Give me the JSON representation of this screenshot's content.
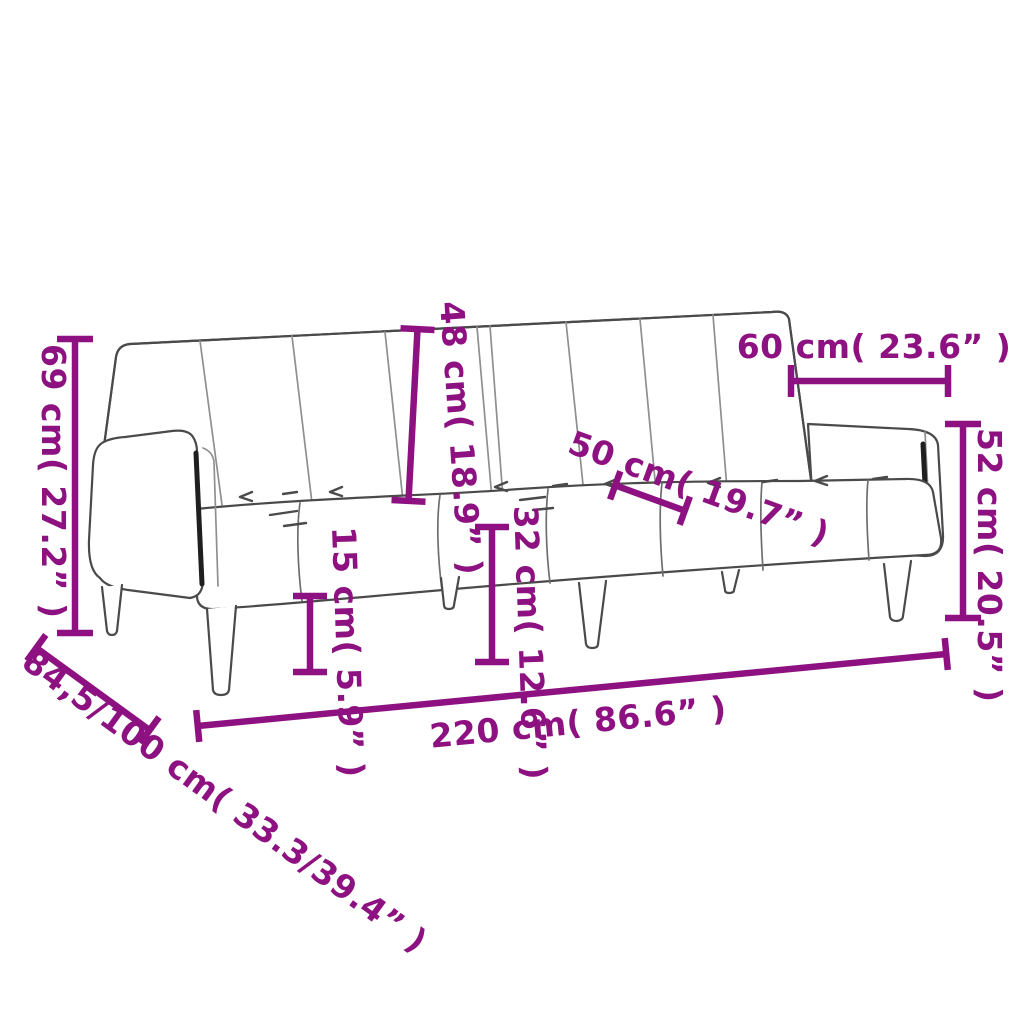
{
  "drawing": {
    "subject": "two-seater sofa bed line drawing with measurements",
    "accent_color": "#8d1180",
    "outline_color": "#4a4a4a",
    "background_color": "#ffffff"
  },
  "dimensions": {
    "overall_height": {
      "label": "69 cm( 27.2” )",
      "cm": "69",
      "inches": "27.2",
      "orientation": "vertical"
    },
    "backrest_height": {
      "label": "48 cm( 18.9” )",
      "cm": "48",
      "inches": "18.9",
      "orientation": "vertical"
    },
    "backrest_section_width": {
      "label": "60 cm( 23.6” )",
      "cm": "60",
      "inches": "23.6",
      "orientation": "horizontal"
    },
    "seat_depth": {
      "label": "50 cm( 19.7” )",
      "cm": "50",
      "inches": "19.7",
      "orientation": "diagonal"
    },
    "armrest_height": {
      "label": "52 cm( 20.5” )",
      "cm": "52",
      "inches": "20.5",
      "orientation": "vertical"
    },
    "leg_height": {
      "label": "15 cm( 5.9” )",
      "cm": "15",
      "inches": "5.9",
      "orientation": "vertical"
    },
    "seat_height": {
      "label": "32 cm( 12.6” )",
      "cm": "32",
      "inches": "12.6",
      "orientation": "vertical"
    },
    "overall_width": {
      "label": "220 cm( 86.6” )",
      "cm": "220",
      "inches": "86.6",
      "orientation": "diagonal"
    },
    "depth_range": {
      "label": "84,5/100 cm( 33.3/39.4” )",
      "cm": "84.5/100",
      "inches": "33.3/39.4",
      "orientation": "diagonal"
    }
  }
}
